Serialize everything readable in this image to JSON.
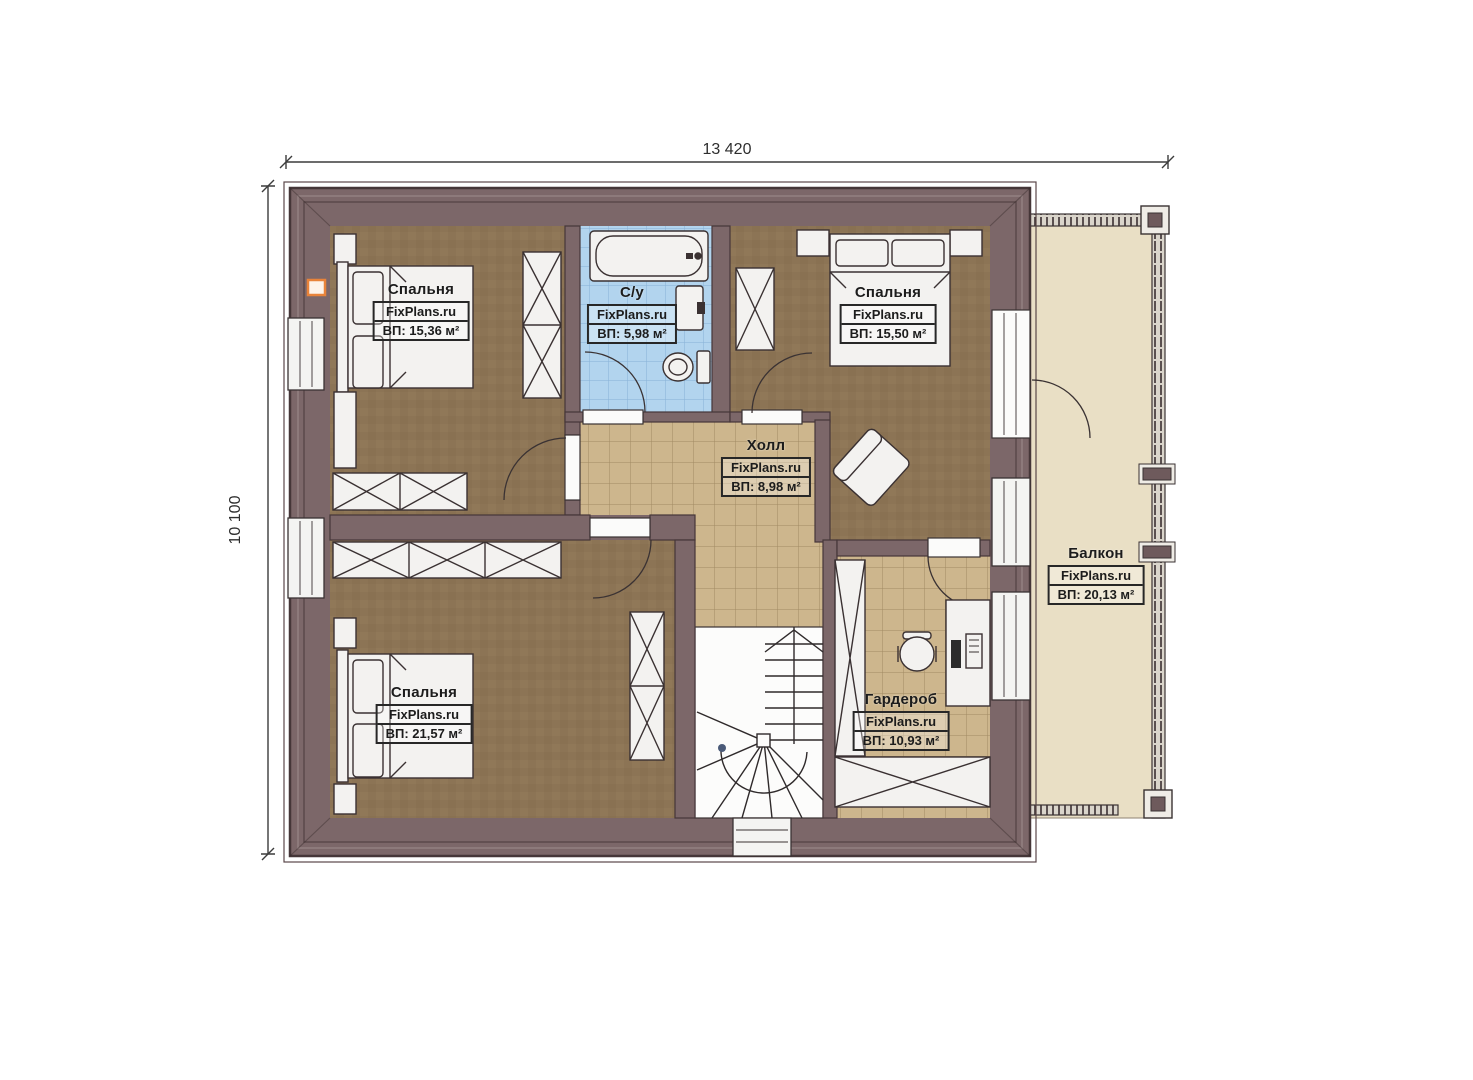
{
  "dimensions": {
    "width_label": "13 420",
    "height_label": "10 100"
  },
  "rooms": [
    {
      "name": "Спальня",
      "brand": "FixPlans.ru",
      "area": "ВП: 15,36 м²"
    },
    {
      "name": "С/у",
      "brand": "FixPlans.ru",
      "area": "ВП: 5,98 м²"
    },
    {
      "name": "Спальня",
      "brand": "FixPlans.ru",
      "area": "ВП: 15,50 м²"
    },
    {
      "name": "Холл",
      "brand": "FixPlans.ru",
      "area": "ВП: 8,98 м²"
    },
    {
      "name": "Спальня",
      "brand": "FixPlans.ru",
      "area": "ВП: 21,57 м²"
    },
    {
      "name": "Гардероб",
      "brand": "FixPlans.ru",
      "area": "ВП: 10,93 м²"
    },
    {
      "name": "Балкон",
      "brand": "FixPlans.ru",
      "area": "ВП: 20,13 м²"
    }
  ],
  "colors": {
    "wall": "#7c6769",
    "wall_outline": "#453638",
    "bedroom_floor": "#8c7455",
    "hall_tile": "#cdb68d",
    "bath_tile": "#b2d4ee",
    "balcony_floor": "#e9dfc5",
    "furniture": "#f3f2f0",
    "marker_orange": "#e8833a"
  }
}
